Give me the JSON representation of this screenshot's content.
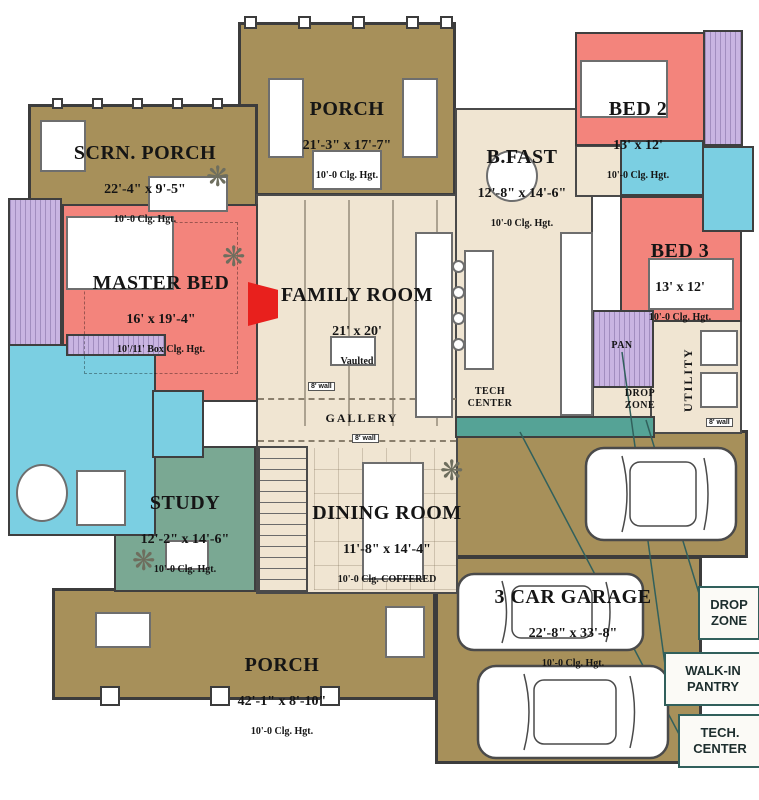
{
  "palette": {
    "porch_olive": "#a7905a",
    "interior_cream": "#f0e5d2",
    "bedroom_salmon": "#f3847c",
    "closet_purple": "#c9b4e2",
    "bath_cyan": "#7bcfe2",
    "study_green": "#7aa893",
    "cabinet_teal": "#55a396",
    "fireplace_red": "#e8201d",
    "callout_border_teal": "#31605c"
  },
  "rooms": {
    "scrn_porch": {
      "name": "SCRN. PORCH",
      "dims": "22'-4\" x 9'-5\"",
      "clg": "10'-0 Clg. Hgt."
    },
    "porch_top": {
      "name": "PORCH",
      "dims": "21'-3\" x 17'-7\"",
      "clg": "10'-0 Clg. Hgt."
    },
    "bfast": {
      "name": "B.FAST",
      "dims": "12'-8\" x 14'-6\"",
      "clg": "10'-0 Clg. Hgt."
    },
    "bed2": {
      "name": "BED 2",
      "dims": "13' x 12'",
      "clg": "10'-0 Clg. Hgt."
    },
    "bed3": {
      "name": "BED 3",
      "dims": "13' x 12'",
      "clg": "10'-0 Clg. Hgt."
    },
    "master_bed": {
      "name": "MASTER BED",
      "dims": "16' x 19'-4\"",
      "clg": "10'/11' Box Clg. Hgt."
    },
    "family_room": {
      "name": "FAMILY ROOM",
      "dims": "21' x 20'",
      "clg": "Vaulted"
    },
    "study": {
      "name": "STUDY",
      "dims": "12'-2\" x 14'-6\"",
      "clg": "10'-0 Clg. Hgt."
    },
    "dining": {
      "name": "DINING ROOM",
      "dims": "11'-8\" x 14'-4\"",
      "clg": "10'-0 Clg. COFFERED"
    },
    "garage": {
      "name": "3 CAR GARAGE",
      "dims": "22'-8\" x 33'-8\"",
      "clg": "10'-0 Clg. Hgt."
    },
    "porch_bottom": {
      "name": "PORCH",
      "dims": "42'-1\" x 8'-10\"",
      "clg": "10'-0 Clg. Hgt."
    },
    "gallery": {
      "name": "GALLERY"
    },
    "tech_center": {
      "name": "TECH\nCENTER"
    },
    "drop_zone": {
      "name": "DROP\nZONE"
    },
    "utility": {
      "name": "UTILITY"
    },
    "pantry": {
      "name": "PAN"
    }
  },
  "callouts": {
    "drop_zone": "DROP\nZONE",
    "walk_in_pantry": "WALK-IN\nPANTRY",
    "tech_center": "TECH.\nCENTER"
  },
  "annotations": {
    "wall_tag": "8' wall"
  }
}
